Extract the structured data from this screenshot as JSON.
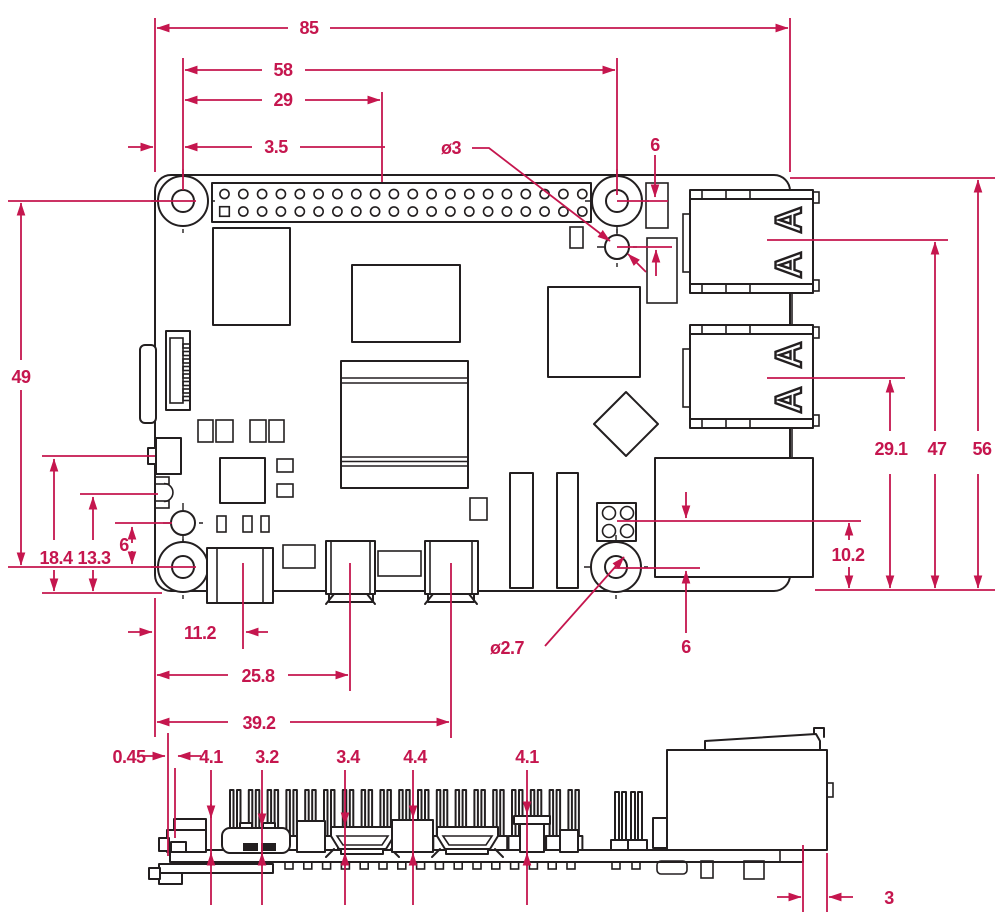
{
  "drawing": {
    "type": "mechanical-dimension-drawing",
    "subject": "single-board-computer top view and side view",
    "colors": {
      "dimension_red": "#c5164e",
      "line_black": "#231f20",
      "background": "#ffffff"
    },
    "dims": {
      "top": {
        "board_width": "85",
        "hole_span_x": "58",
        "gpio_center": "29",
        "hole_inset_x": "3.5",
        "hole_dia": "ø3",
        "aux_hole_gap_topright": "6",
        "hole_span_y": "49",
        "comp_height_a": "18.4",
        "comp_height_b": "13.3",
        "aux_hole_gap_left": "6",
        "usbc_center": "11.2",
        "hdmi0_center": "25.8",
        "hdmi1_center": "39.2",
        "mount_hole_dia": "ø2.7",
        "poe_gap": "6",
        "usb_lower_center": "29.1",
        "usb_upper_center": "47",
        "board_height": "56",
        "eth_center": "10.2"
      },
      "side": {
        "edge_clearance": "0.45",
        "h_sd_reader": "4.1",
        "h_usbc": "3.2",
        "h_hdmi": "3.4",
        "h_mid_connector": "4.4",
        "h_post": "4.1",
        "eth_overhang": "3"
      }
    }
  }
}
